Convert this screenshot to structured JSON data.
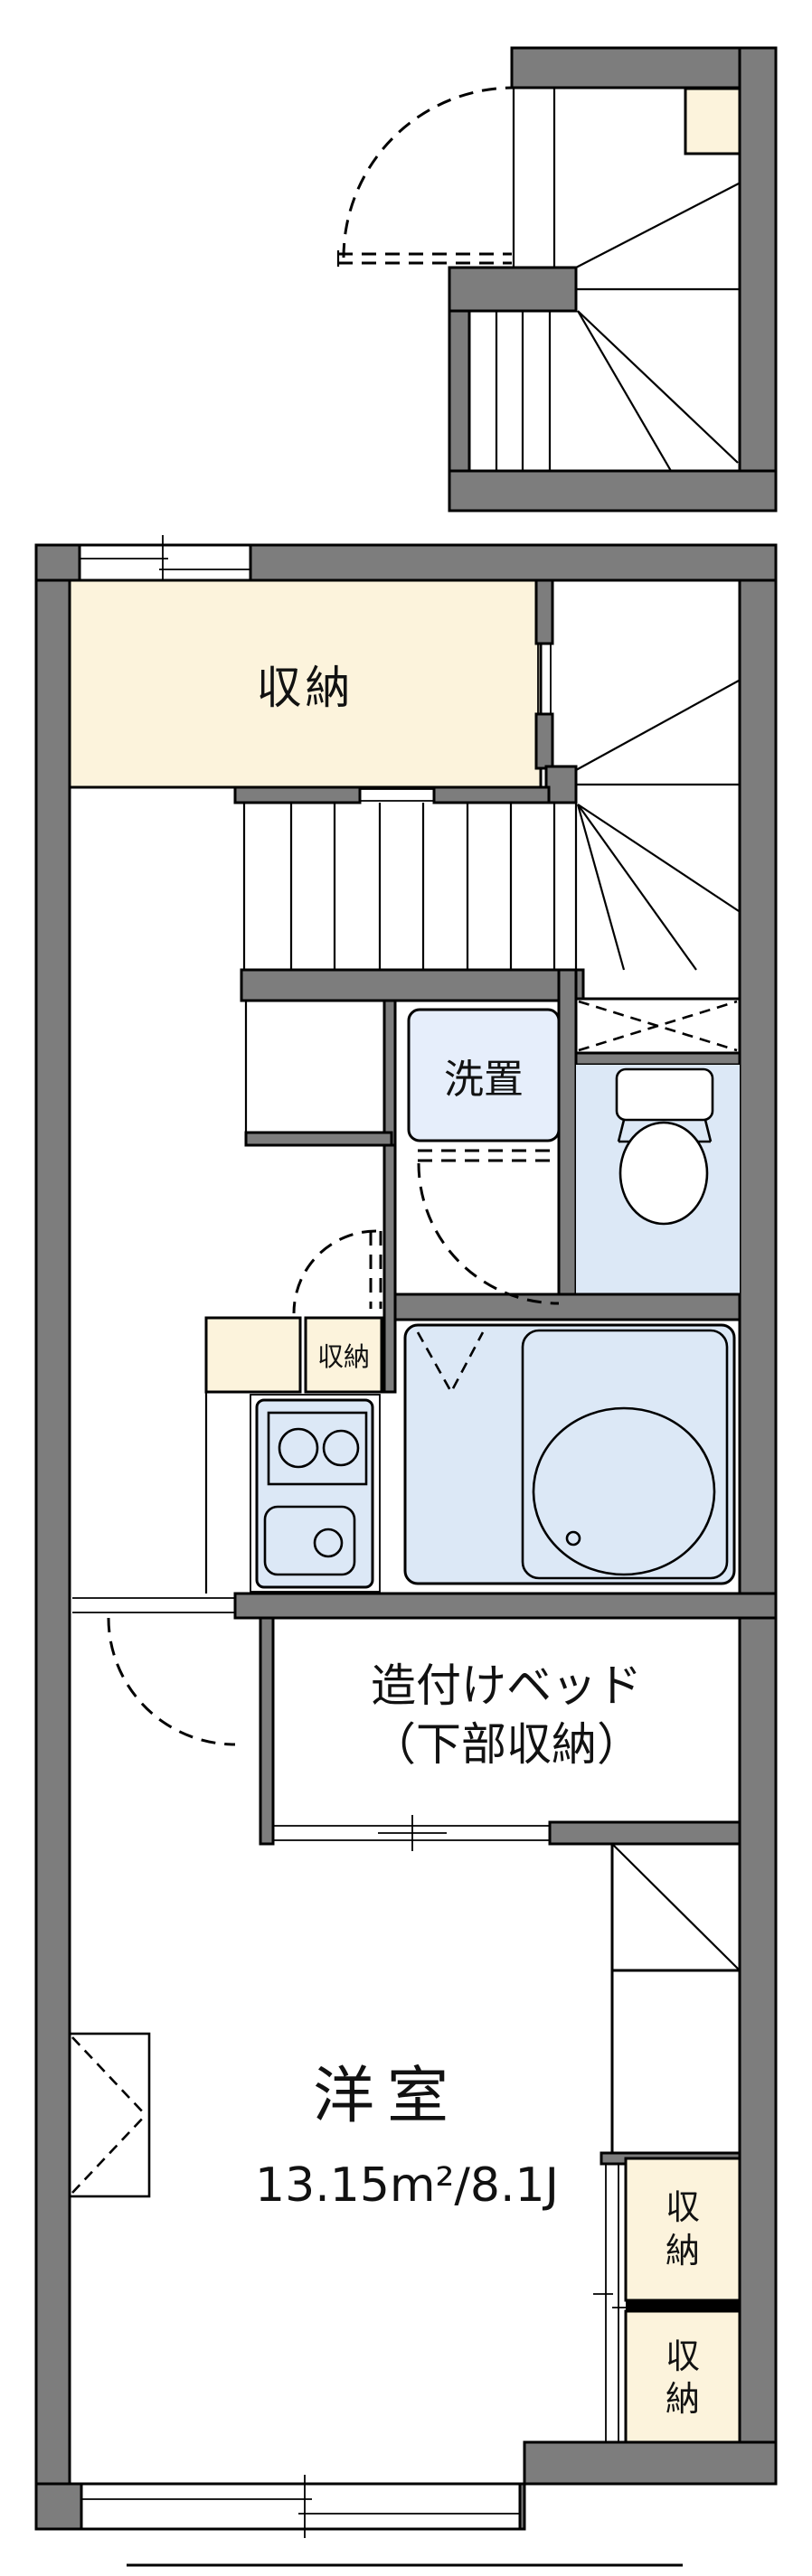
{
  "floorplan": {
    "labels": {
      "closet_main": "収納",
      "washer_space": "洗置",
      "closet_small": "収納",
      "built_in_bed": "造付けベッド\n（下部収納）",
      "room_name": "洋室",
      "room_area": "13.15m²/8.1J",
      "closet_right_upper": "収納",
      "closet_right_lower": "収納"
    },
    "colors": {
      "wall": "#7d7d7d",
      "cream": "#fcf3dc",
      "wet": "#dce8f6",
      "wet_light": "#e6eefb",
      "line": "#000000",
      "bg": "#ffffff"
    }
  }
}
